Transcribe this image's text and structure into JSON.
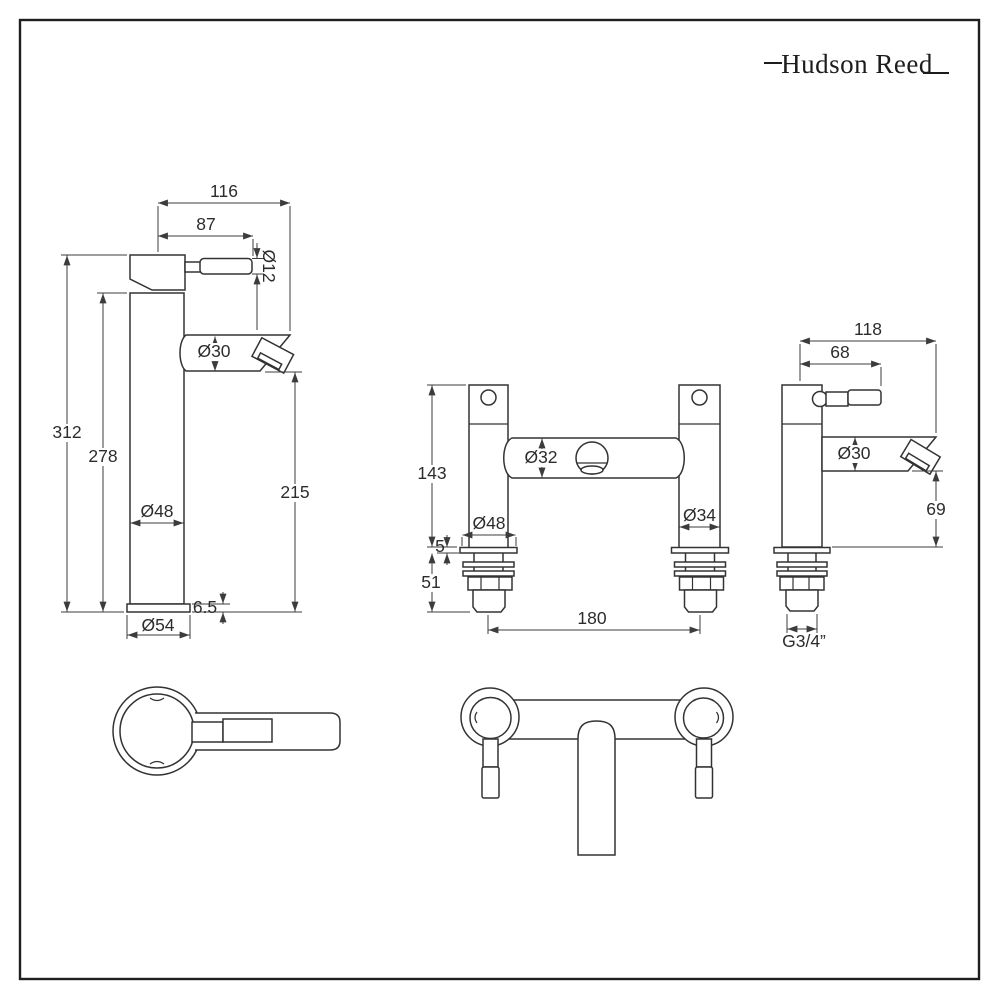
{
  "brand": {
    "logo_text": "Hudson Reed"
  },
  "colors": {
    "line": "#333333",
    "dimension": "#3c3c3c",
    "background": "#ffffff",
    "border": "#1f1f1f"
  },
  "views": {
    "tall_tap_front": {
      "labels": {
        "total_projection": "116",
        "handle_projection": "87",
        "handle_diameter": "Ø12",
        "spout_diameter": "Ø30",
        "overall_height": "312",
        "body_height": "278",
        "spout_height": "215",
        "body_diameter": "Ø48",
        "base_thickness": "6.5",
        "base_diameter": "Ø54"
      }
    },
    "bath_filler_front": {
      "labels": {
        "body_height": "143",
        "left_column_diameter": "Ø48",
        "crossbar_diameter": "Ø32",
        "right_column_diameter": "Ø34",
        "flange_thickness": "5",
        "under_deck_length": "51",
        "tap_centres": "180"
      }
    },
    "bath_filler_side": {
      "labels": {
        "total_projection": "118",
        "handle_projection": "68",
        "spout_diameter": "Ø30",
        "spout_clearance": "69",
        "thread_size": "G3/4”"
      }
    }
  }
}
